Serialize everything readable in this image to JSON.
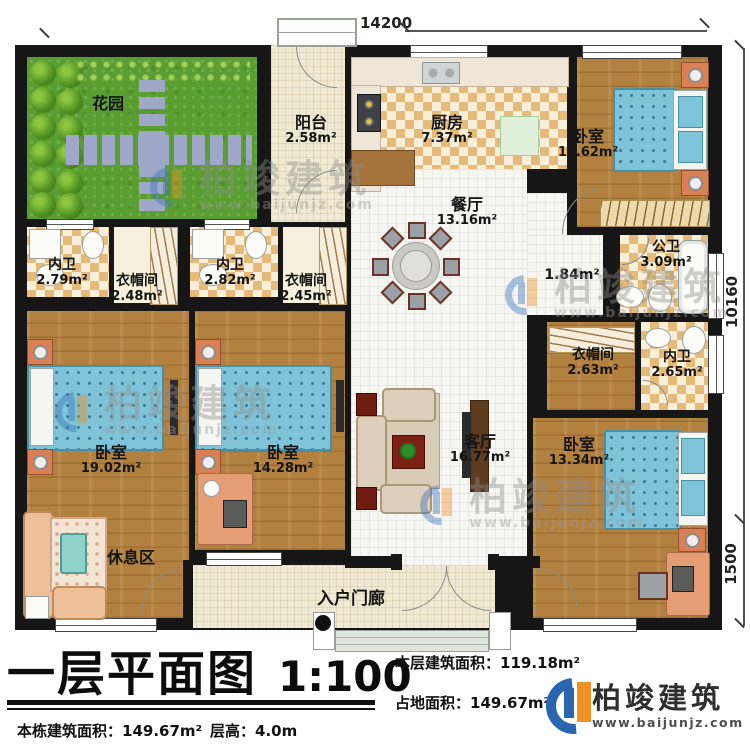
{
  "plan": {
    "dims": {
      "top": "14200",
      "right_upper": "10160",
      "right_lower": "1500"
    },
    "rooms": {
      "garden": {
        "label": "花园",
        "area": ""
      },
      "balcony": {
        "label": "阳台",
        "area": "2.58m²"
      },
      "kitchen": {
        "label": "厨房",
        "area": "7.37m²"
      },
      "bedroom_tr": {
        "label": "卧室",
        "area": "10.62m²"
      },
      "dining": {
        "label": "餐厅",
        "area": "13.16m²"
      },
      "bath1": {
        "label": "内卫",
        "area": "2.79m²"
      },
      "closet1": {
        "label": "衣帽间",
        "area": "2.48m²"
      },
      "bath2": {
        "label": "内卫",
        "area": "2.82m²"
      },
      "closet2": {
        "label": "衣帽间",
        "area": "2.45m²"
      },
      "hall": {
        "label": "",
        "area": "1.84m²"
      },
      "public_bath": {
        "label": "公卫",
        "area": "3.09m²"
      },
      "closet3": {
        "label": "衣帽间",
        "area": "2.63m²"
      },
      "bath3": {
        "label": "内卫",
        "area": "2.65m²"
      },
      "bedroom_left": {
        "label": "卧室",
        "area": "19.02m²"
      },
      "rest": {
        "label": "休息区",
        "area": ""
      },
      "bedroom_mid": {
        "label": "卧室",
        "area": "14.28m²"
      },
      "living": {
        "label": "客厅",
        "area": "16.77m²"
      },
      "bedroom_right": {
        "label": "卧室",
        "area": "13.34m²"
      },
      "porch": {
        "label": "入户门廊",
        "area": ""
      }
    }
  },
  "title_block": {
    "title": "一层平面图",
    "scale": "1:100",
    "floor_area_label": "本层建筑面积：",
    "floor_area_value": "119.18m²",
    "land_area_label": "占地面积：",
    "land_area_value": "149.67m²",
    "total_area_label": "本栋建筑面积：",
    "total_area_value": "149.67m²",
    "floor_height_label": "层高：",
    "floor_height_value": "4.0m"
  },
  "logo": {
    "name": "柏竣建筑",
    "url": "www.baijunjz.com"
  },
  "watermark": {
    "brand": "柏竣建筑",
    "url": "www.baijunjz.com"
  }
}
